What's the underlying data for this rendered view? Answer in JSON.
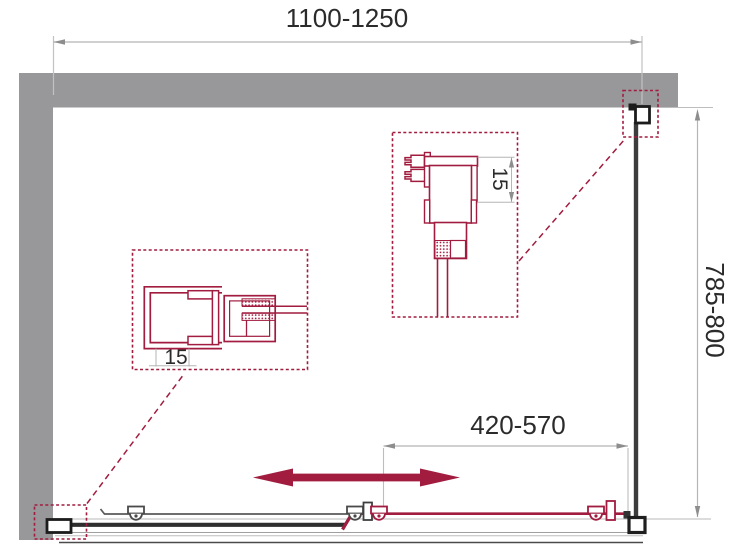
{
  "drawing": {
    "type": "shower-enclosure-installation-diagram",
    "dimensions": {
      "width_range": "1100-1250",
      "depth_range": "785-800",
      "door_opening_range": "420-570",
      "left_profile_adjustment": "15",
      "top_profile_adjustment": "15"
    },
    "colors": {
      "accent_red": "#a11c3f",
      "wall_gray": "#98989a",
      "line_dark": "#333333",
      "dim_line_gray": "#b5b5b5",
      "text": "#2b2b2b"
    }
  }
}
